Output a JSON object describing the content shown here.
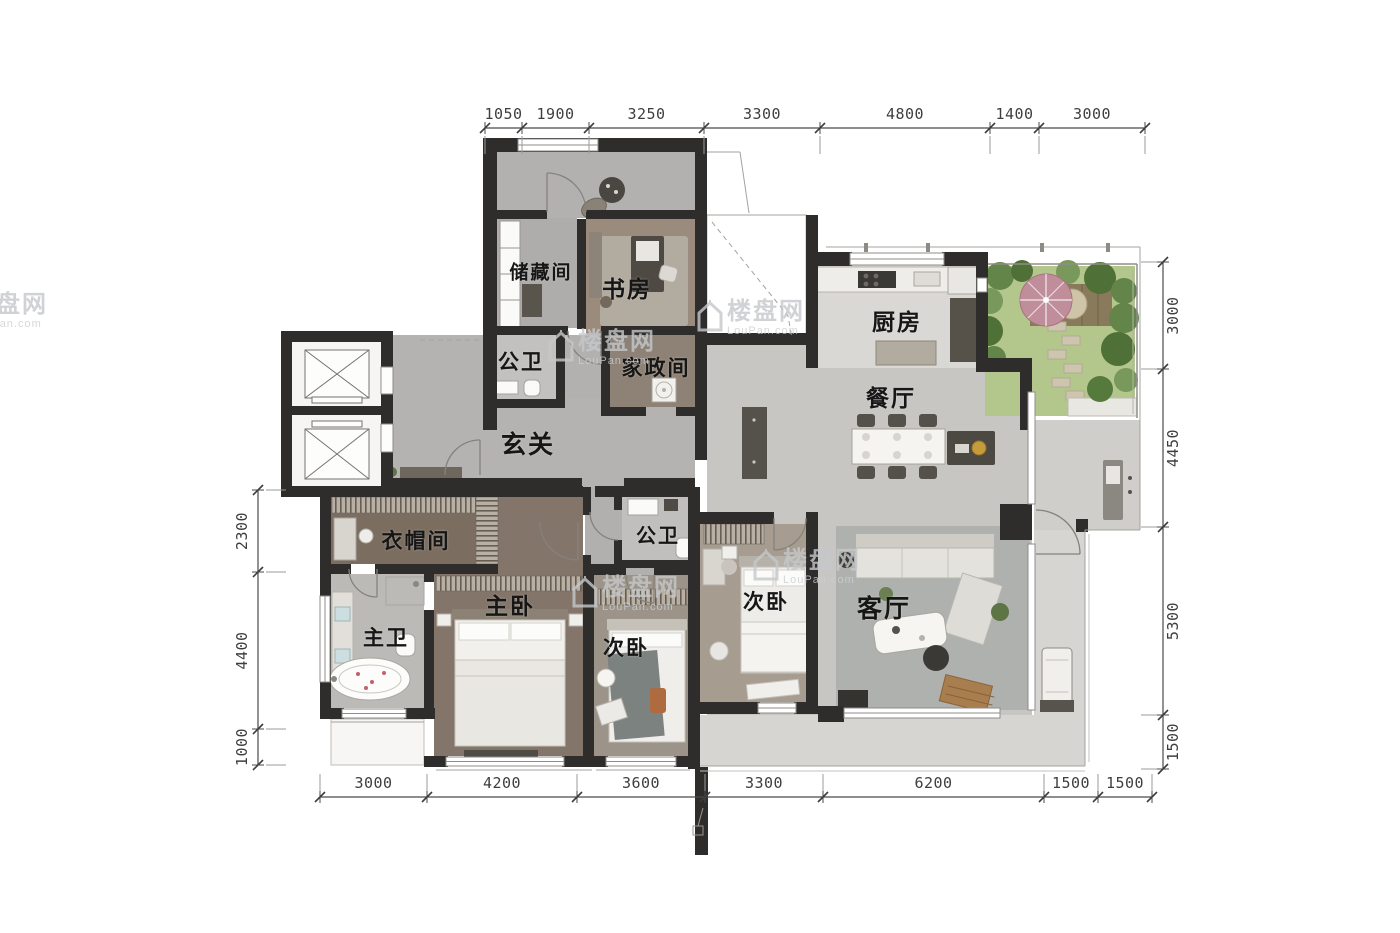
{
  "watermark": {
    "name_cn": "楼盘网",
    "site": "LouPan.com"
  },
  "rooms": [
    {
      "id": "storage",
      "label": "储藏间"
    },
    {
      "id": "study",
      "label": "书房"
    },
    {
      "id": "bath-top",
      "label": "公卫"
    },
    {
      "id": "housekeeping",
      "label": "家政间"
    },
    {
      "id": "kitchen",
      "label": "厨房"
    },
    {
      "id": "dining",
      "label": "餐厅"
    },
    {
      "id": "foyer",
      "label": "玄关"
    },
    {
      "id": "cloakroom",
      "label": "衣帽间"
    },
    {
      "id": "master-bath",
      "label": "主卫"
    },
    {
      "id": "master-bedroom",
      "label": "主卧"
    },
    {
      "id": "bedroom-2",
      "label": "次卧"
    },
    {
      "id": "bath-mid",
      "label": "公卫"
    },
    {
      "id": "bedroom-3",
      "label": "次卧"
    },
    {
      "id": "living",
      "label": "客厅"
    }
  ],
  "dimensions": {
    "top": [
      "1050",
      "1900",
      "3250",
      "3300",
      "4800",
      "1400",
      "3000"
    ],
    "bottom": [
      "3000",
      "4200",
      "3600",
      "3300",
      "6200",
      "1500",
      "1500"
    ],
    "left": [
      "2300",
      "4400",
      "1000"
    ],
    "right": [
      "3000",
      "4450",
      "5300",
      "1500"
    ]
  },
  "colors": {
    "wall": "#2e2d2b",
    "lawn": "#b3c68c",
    "umbrella": "#c08e9b",
    "gold_accent": "#c59b3c"
  }
}
